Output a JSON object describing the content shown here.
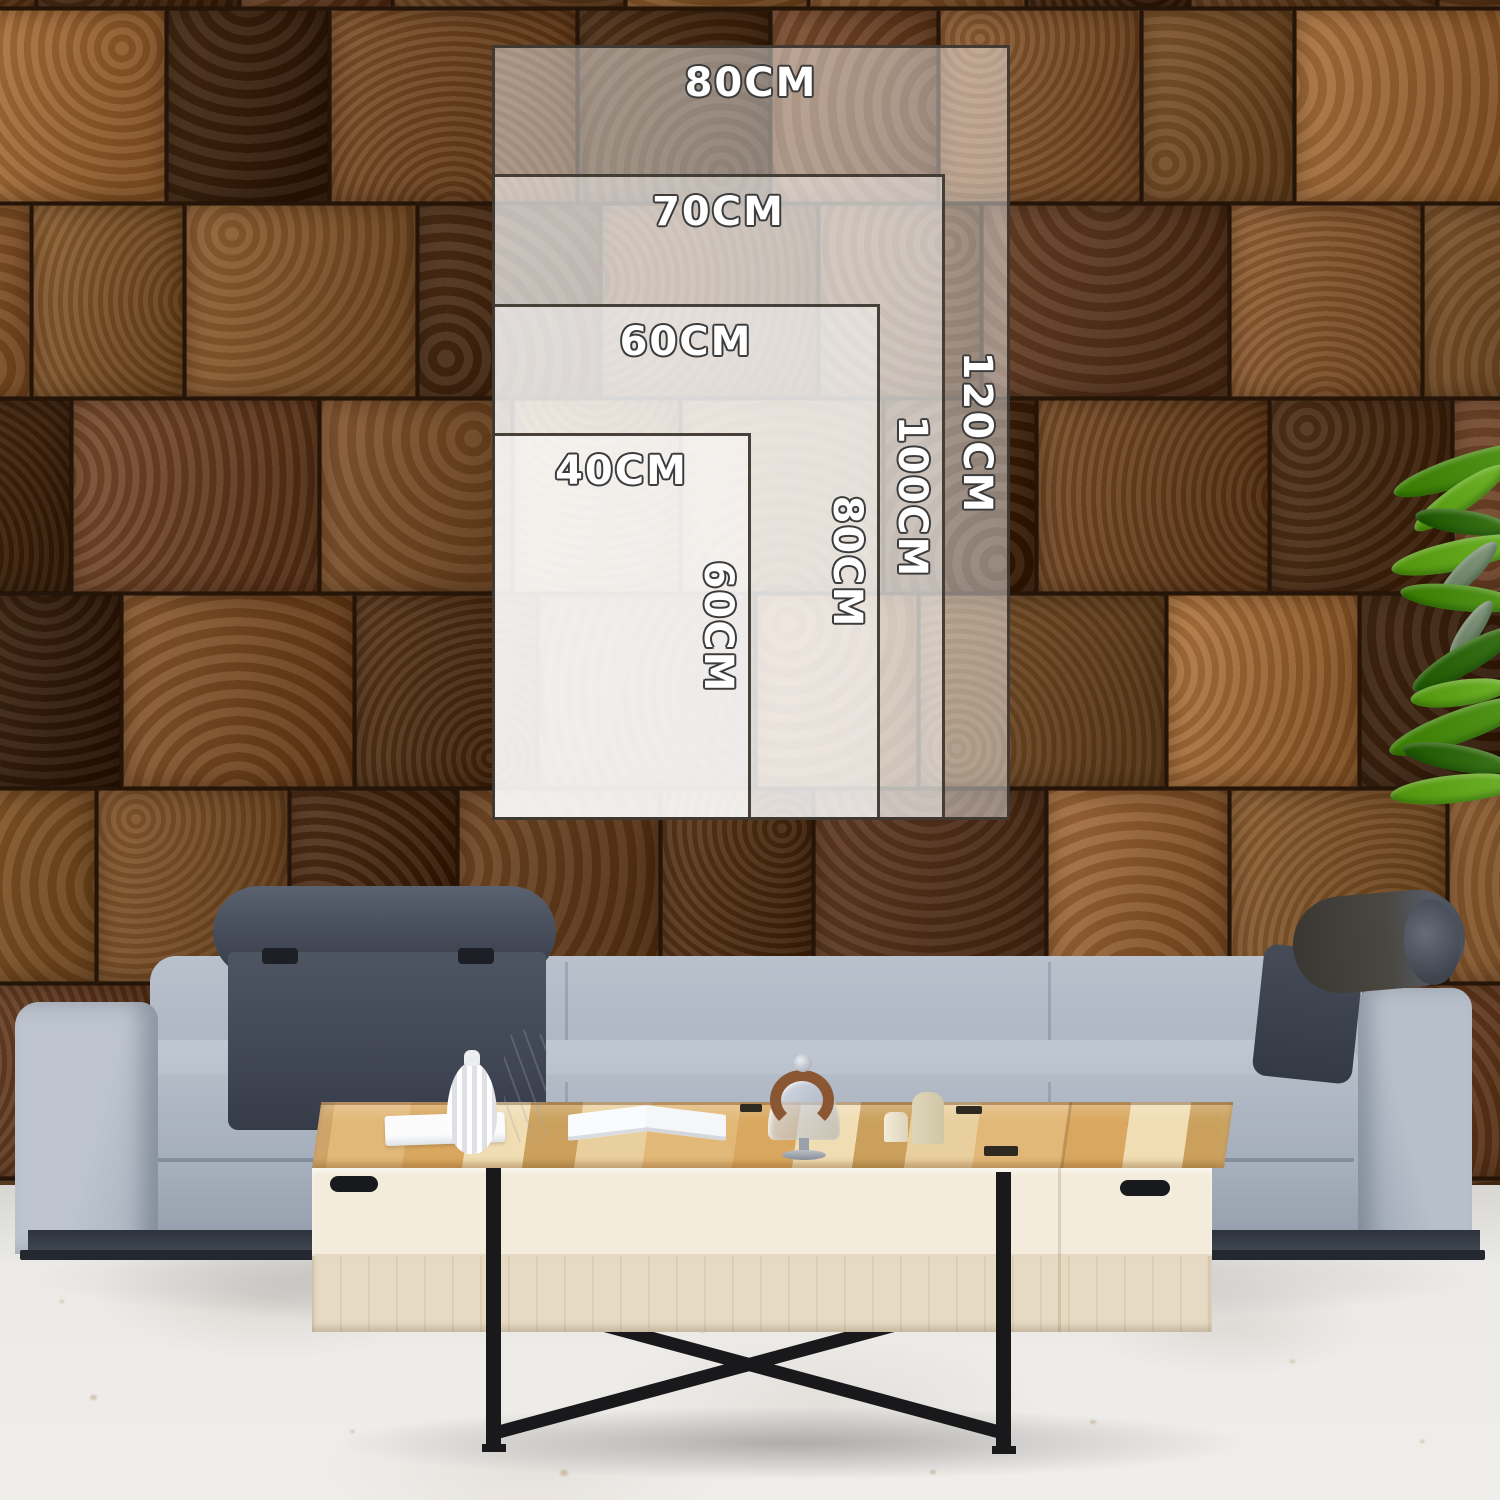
{
  "image_type": "wall-art size chart mockup in living room",
  "size_chart": {
    "unit": "CM",
    "anchor": {
      "left_px": 492,
      "bottom_px": 820,
      "px_per_cm_x": 6.47,
      "px_per_cm_y": 6.455
    },
    "sizes": [
      {
        "width_label": "80CM",
        "height_label": "120CM",
        "width_cm": 80,
        "height_cm": 120
      },
      {
        "width_label": "70CM",
        "height_label": "100CM",
        "width_cm": 70,
        "height_cm": 100
      },
      {
        "width_label": "60CM",
        "height_label": "80CM",
        "width_cm": 60,
        "height_cm": 80
      },
      {
        "width_label": "40CM",
        "height_label": "60CM",
        "width_cm": 40,
        "height_cm": 60
      }
    ]
  },
  "scene": {
    "wall": {
      "material": "end-grain wood blocks",
      "palette": [
        "#7b4f2a",
        "#8f6134",
        "#5d3a1e",
        "#a06b3a",
        "#6e452a",
        "#4a2d17",
        "#916036"
      ]
    },
    "floor": {
      "color": "#eae8e5"
    },
    "sofa": {
      "fabric_color": "#aab3c0",
      "headrest_color": "#474e5c",
      "plinth_color": "#343b46"
    },
    "table": {
      "wood_color": "#e2b878",
      "face_color": "#f3ecdc",
      "leg_color": "#19191b"
    },
    "plant": {
      "leaf_colors": [
        "#57991f",
        "#6fb32a",
        "#3c751a",
        "#84997f"
      ]
    },
    "overlay": {
      "fill": "rgba(255,255,255,0.45)",
      "border_color": "#38322a",
      "label_color": "#ffffff",
      "label_outline": "#3c3c3c"
    }
  }
}
